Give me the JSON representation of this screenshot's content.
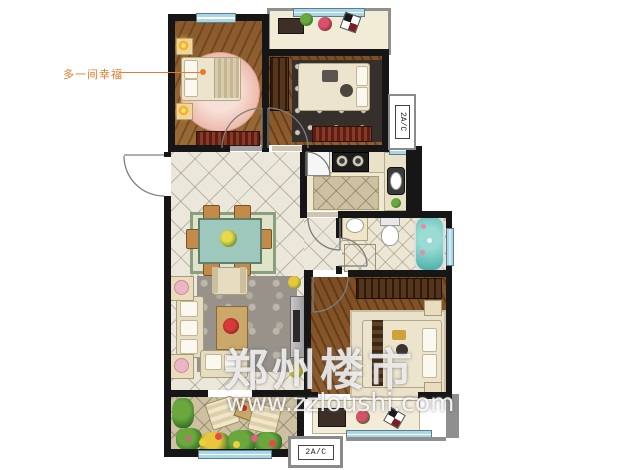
{
  "annotation": {
    "label": "多一间幸福",
    "color": "#e87a2e"
  },
  "watermark": {
    "title": "郑州楼市",
    "url": "www.zzloushi.com"
  },
  "ac_units": {
    "right_label": "2A/C",
    "bottom_label": "2A/C"
  },
  "colors": {
    "wall": "#161616",
    "window_blue": "#a9d7e8",
    "wood_floor": "#8a5a2c",
    "tile_floor": "#ece7db",
    "balcony_tile": "#cdc1a2",
    "bathtub_teal": "#63bfb8",
    "platform_gray": "#8f8f8f",
    "accent_orange": "#e87a2e",
    "watermark_white": "#ffffff"
  }
}
